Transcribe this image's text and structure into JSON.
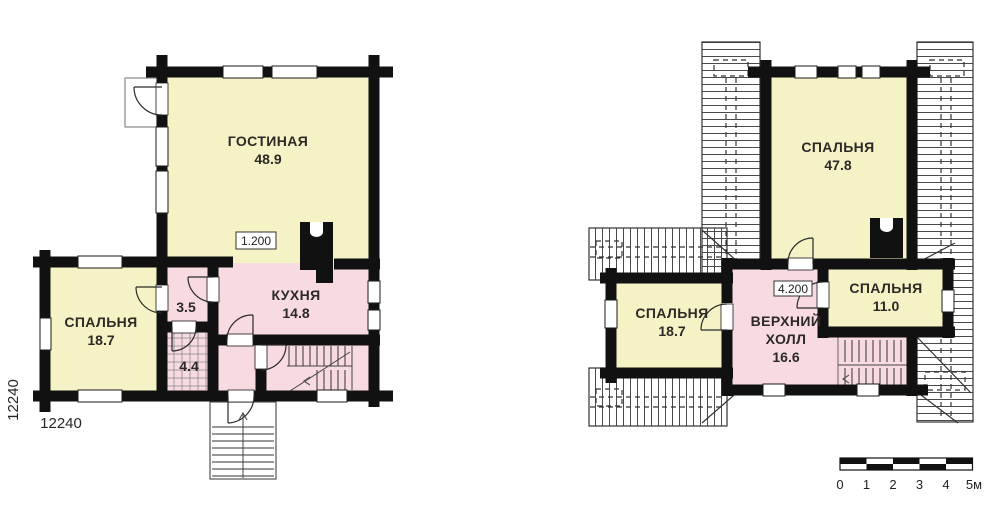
{
  "colors": {
    "wall": "#111111",
    "room_yellow": "#f5f2c5",
    "room_pink": "#f8dbe1",
    "text": "#2c2926"
  },
  "floor1": {
    "elevation": "1.200",
    "dim_left": "12240",
    "dim_bottom": "12240",
    "rooms": {
      "living": {
        "label": "ГОСТИНАЯ",
        "area": "48.9"
      },
      "bedroom": {
        "label": "СПАЛЬНЯ",
        "area": "18.7"
      },
      "kitchen": {
        "label": "КУХНЯ",
        "area": "14.8"
      },
      "bath": {
        "area": "3.5"
      },
      "storage": {
        "area": "4.4"
      }
    }
  },
  "floor2": {
    "elevation": "4.200",
    "rooms": {
      "bedroom_big": {
        "label": "СПАЛЬНЯ",
        "area": "47.8"
      },
      "bedroom_left": {
        "label": "СПАЛЬНЯ",
        "area": "18.7"
      },
      "bedroom_right": {
        "label": "СПАЛЬНЯ",
        "area": "11.0"
      },
      "hall": {
        "label_line1": "ВЕРХНИЙ",
        "label_line2": "ХОЛЛ",
        "area": "16.6"
      }
    }
  },
  "scale_bar": {
    "labels": [
      "0",
      "1",
      "2",
      "3",
      "4",
      "5м"
    ]
  }
}
